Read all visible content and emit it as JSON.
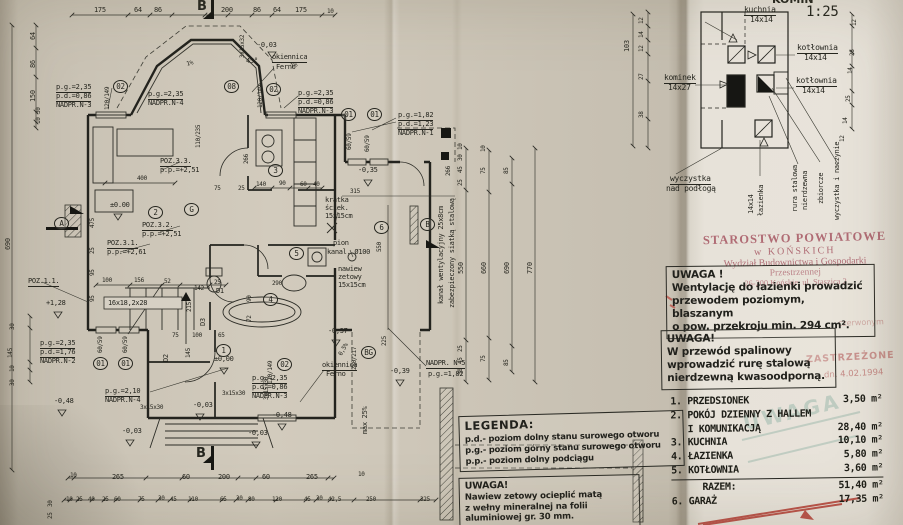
{
  "stamp": {
    "l1": "STAROSTWO POWIATOWE",
    "l2": "w KOŃSKICH",
    "l3": "Wydział Budownictwa i Gospodarki",
    "l4": "Przestrzennej",
    "l5": "26-200 Końskie, ul. Staszica 2"
  },
  "ghost": {
    "red1": "czerwonym",
    "red2": "ZASTRZEŻONE",
    "red3": "dn. 4.02.1994",
    "teal": "UWAGA"
  },
  "note_vent": {
    "title": "UWAGA !",
    "lines": [
      "Wentylację do łazienki prowadzić",
      "przewodem poziomym, blaszanym",
      "o pow. przekroju min. 294 cm²."
    ]
  },
  "note_spal": {
    "title": "UWAGA!",
    "lines": [
      "W przewód spalinowy",
      "wprowadzić rurę stalową",
      "nierdzewną kwasoodporną."
    ]
  },
  "note_nawiew": {
    "title": "UWAGA!",
    "lines": [
      "Nawiew zetowy ocieplić matą",
      "z wełny mineralnej na folii",
      "aluminiowej gr. 30 mm."
    ]
  },
  "legend": {
    "title": "LEGENDA:",
    "items": [
      "p.d.- poziom dolny stanu surowego otworu",
      "p.g.- poziom górny stanu surowego otworu",
      "p.p.- poziom dolny podciągu"
    ]
  },
  "schedule": {
    "rows": [
      {
        "l": "1. PRZEDSIONEK",
        "r": "3,50 m²"
      },
      {
        "l": "2. POKÓJ DZIENNY Z HALLEM",
        "r": ""
      },
      {
        "l": "   I KOMUNIKACJĄ",
        "r": "28,40 m²"
      },
      {
        "l": "3. KUCHNIA",
        "r": "10,10 m²"
      },
      {
        "l": "4. ŁAZIENKA",
        "r": "5,80 m²"
      },
      {
        "l": "5. KOTŁOWNIA",
        "r": "3,60 m²"
      }
    ],
    "total": {
      "l": "RAZEM:",
      "r": "51,40 m²"
    },
    "extra": {
      "l": "6. GARAŻ",
      "r": "17,35 m²"
    }
  },
  "labels": [
    {
      "t": "KOMIN",
      "x": 772,
      "y": -6,
      "s": 11,
      "k": "b"
    },
    {
      "t": "1:25",
      "x": 806,
      "y": 5,
      "s": 14
    },
    {
      "t": "kuchnia",
      "x": 744,
      "y": 6,
      "s": 8,
      "k": "u"
    },
    {
      "t": "14x14",
      "x": 750,
      "y": 16,
      "s": 8
    },
    {
      "t": "kotłownia",
      "x": 797,
      "y": 44,
      "s": 8,
      "k": "u"
    },
    {
      "t": "14x14",
      "x": 804,
      "y": 54,
      "s": 8
    },
    {
      "t": "kominek",
      "x": 664,
      "y": 74,
      "s": 8,
      "k": "u"
    },
    {
      "t": "14x27",
      "x": 668,
      "y": 84,
      "s": 8
    },
    {
      "t": "kotłownia",
      "x": 796,
      "y": 77,
      "s": 8,
      "k": "u"
    },
    {
      "t": "14x14",
      "x": 802,
      "y": 87,
      "s": 8
    },
    {
      "t": "wyczystka",
      "x": 670,
      "y": 175,
      "s": 8,
      "k": "u"
    },
    {
      "t": "nad podłogą",
      "x": 666,
      "y": 185,
      "s": 8
    },
    {
      "t": "14x14",
      "x": 748,
      "y": 214,
      "r": -90
    },
    {
      "t": "łazienka",
      "x": 758,
      "y": 216,
      "r": -90
    },
    {
      "t": "rura stalowa",
      "x": 792,
      "y": 212,
      "r": -90
    },
    {
      "t": "nierdzewna",
      "x": 802,
      "y": 210,
      "r": -90
    },
    {
      "t": "zbiorcze",
      "x": 818,
      "y": 204,
      "r": -90
    },
    {
      "t": "wyczystka i naczynie",
      "x": 834,
      "y": 220,
      "r": -90
    },
    {
      "t": "103",
      "x": 624,
      "y": 52,
      "r": -90
    },
    {
      "t": "12",
      "x": 639,
      "y": 24,
      "r": -90,
      "s": 6
    },
    {
      "t": "14",
      "x": 639,
      "y": 38,
      "r": -90,
      "s": 6
    },
    {
      "t": "12",
      "x": 639,
      "y": 52,
      "r": -90,
      "s": 6
    },
    {
      "t": "27",
      "x": 639,
      "y": 80,
      "r": -90,
      "s": 6
    },
    {
      "t": "38",
      "x": 639,
      "y": 118,
      "r": -90,
      "s": 6
    },
    {
      "t": "12",
      "x": 852,
      "y": 26,
      "r": -90,
      "s": 6
    },
    {
      "t": "26",
      "x": 850,
      "y": 56,
      "r": -90,
      "s": 6
    },
    {
      "t": "14",
      "x": 848,
      "y": 74,
      "r": -90,
      "s": 6
    },
    {
      "t": "25",
      "x": 846,
      "y": 102,
      "r": -90,
      "s": 6
    },
    {
      "t": "14",
      "x": 843,
      "y": 124,
      "r": -90,
      "s": 6
    },
    {
      "t": "12",
      "x": 840,
      "y": 142,
      "r": -90,
      "s": 6
    },
    {
      "t": "175",
      "x": 94,
      "y": 7
    },
    {
      "t": "64",
      "x": 134,
      "y": 7
    },
    {
      "t": "86",
      "x": 154,
      "y": 7
    },
    {
      "t": "B",
      "x": 197,
      "y": 0,
      "s": 13,
      "k": "b"
    },
    {
      "t": "200",
      "x": 221,
      "y": 7
    },
    {
      "t": "86",
      "x": 253,
      "y": 7
    },
    {
      "t": "64",
      "x": 273,
      "y": 7
    },
    {
      "t": "175",
      "x": 295,
      "y": 7
    },
    {
      "t": "10",
      "x": 327,
      "y": 9,
      "s": 6
    },
    {
      "t": "64",
      "x": 30,
      "y": 40,
      "r": -90
    },
    {
      "t": "86",
      "x": 30,
      "y": 68,
      "r": -90
    },
    {
      "t": "150",
      "x": 30,
      "y": 102,
      "r": -90
    },
    {
      "t": "30",
      "x": 36,
      "y": 114,
      "r": -90,
      "s": 6
    },
    {
      "t": "10",
      "x": 36,
      "y": 124,
      "r": -90,
      "s": 6
    },
    {
      "t": "690",
      "x": 5,
      "y": 250,
      "r": -90
    },
    {
      "t": "p.g.=2,35",
      "x": 56,
      "y": 84,
      "k": "u"
    },
    {
      "t": "p.d.=0,86",
      "x": 56,
      "y": 93,
      "k": "u"
    },
    {
      "t": "NADPR.N-3",
      "x": 56,
      "y": 102
    },
    {
      "t": "120/149",
      "x": 105,
      "y": 110,
      "r": -90,
      "s": 6
    },
    {
      "t": "02",
      "x": 113,
      "y": 80,
      "k": "c"
    },
    {
      "t": "p.g.=2,35",
      "x": 148,
      "y": 91,
      "k": "u"
    },
    {
      "t": "NADPR.N-4",
      "x": 148,
      "y": 100
    },
    {
      "t": "08",
      "x": 224,
      "y": 80,
      "k": "c"
    },
    {
      "t": "okiennica",
      "x": 272,
      "y": 54,
      "k": "u"
    },
    {
      "t": "Ferno",
      "x": 276,
      "y": 64
    },
    {
      "t": "3x15x32",
      "x": 240,
      "y": 58,
      "r": -90,
      "s": 6
    },
    {
      "t": "-0,03",
      "x": 257,
      "y": 42
    },
    {
      "t": "45°",
      "x": 246,
      "y": 58
    },
    {
      "t": "1%",
      "x": 186,
      "y": 62,
      "r": -15,
      "s": 6
    },
    {
      "t": "1%",
      "x": 290,
      "y": 64,
      "r": -15,
      "s": 6
    },
    {
      "t": "120/149",
      "x": 258,
      "y": 108,
      "r": -90,
      "s": 6
    },
    {
      "t": "02",
      "x": 266,
      "y": 83,
      "k": "c"
    },
    {
      "t": "p.g.=2,35",
      "x": 298,
      "y": 90,
      "k": "u"
    },
    {
      "t": "p.d.=0,86",
      "x": 298,
      "y": 99,
      "k": "u"
    },
    {
      "t": "NADPR.N-3",
      "x": 298,
      "y": 108
    },
    {
      "t": "01",
      "x": 341,
      "y": 108,
      "k": "c"
    },
    {
      "t": "01",
      "x": 367,
      "y": 108,
      "k": "c"
    },
    {
      "t": "60/59",
      "x": 347,
      "y": 150,
      "r": -90,
      "s": 6
    },
    {
      "t": "60/59",
      "x": 365,
      "y": 152,
      "r": -90,
      "s": 6
    },
    {
      "t": "p.g.=1,82",
      "x": 398,
      "y": 112,
      "k": "u"
    },
    {
      "t": "p.d.=1,23",
      "x": 398,
      "y": 121,
      "k": "u"
    },
    {
      "t": "NADPR.N-1",
      "x": 398,
      "y": 130
    },
    {
      "t": "110/235",
      "x": 196,
      "y": 148,
      "r": -90,
      "s": 6
    },
    {
      "t": "266",
      "x": 244,
      "y": 164,
      "r": -90,
      "s": 6
    },
    {
      "t": "266",
      "x": 446,
      "y": 176,
      "r": -90,
      "s": 6
    },
    {
      "t": "POZ.3.3.",
      "x": 160,
      "y": 158,
      "k": "u"
    },
    {
      "t": "p.p.=+2,51",
      "x": 160,
      "y": 167
    },
    {
      "t": "400",
      "x": 137,
      "y": 176,
      "s": 6
    },
    {
      "t": "75",
      "x": 214,
      "y": 186,
      "s": 6
    },
    {
      "t": "25",
      "x": 238,
      "y": 186,
      "s": 6
    },
    {
      "t": "±0.00",
      "x": 110,
      "y": 202
    },
    {
      "t": "2",
      "x": 148,
      "y": 206,
      "k": "c"
    },
    {
      "t": "G",
      "x": 184,
      "y": 203,
      "k": "c"
    },
    {
      "t": "POZ.3.2.",
      "x": 142,
      "y": 222,
      "k": "u"
    },
    {
      "t": "p.p.=+2,51",
      "x": 142,
      "y": 231
    },
    {
      "t": "POZ.3.1.",
      "x": 107,
      "y": 240,
      "k": "u"
    },
    {
      "t": "p.p.=+2,61",
      "x": 107,
      "y": 249
    },
    {
      "t": "POZ.1.1.",
      "x": 28,
      "y": 278,
      "k": "u"
    },
    {
      "t": "+1,28",
      "x": 46,
      "y": 300
    },
    {
      "t": "475",
      "x": 90,
      "y": 228,
      "r": -90,
      "s": 6
    },
    {
      "t": "25",
      "x": 90,
      "y": 254,
      "r": -90,
      "s": 6
    },
    {
      "t": "95",
      "x": 90,
      "y": 276,
      "r": -90,
      "s": 6
    },
    {
      "t": "95",
      "x": 90,
      "y": 302,
      "r": -90,
      "s": 6
    },
    {
      "t": "A",
      "x": 54,
      "y": 217,
      "k": "c"
    },
    {
      "t": "3",
      "x": 268,
      "y": 164,
      "k": "c"
    },
    {
      "t": "140",
      "x": 256,
      "y": 182,
      "s": 6
    },
    {
      "t": "90",
      "x": 279,
      "y": 181,
      "s": 6
    },
    {
      "t": "60",
      "x": 300,
      "y": 182,
      "s": 6
    },
    {
      "t": "40",
      "x": 313,
      "y": 182,
      "s": 6
    },
    {
      "t": "-0,35",
      "x": 358,
      "y": 167
    },
    {
      "t": "315",
      "x": 350,
      "y": 189,
      "s": 6
    },
    {
      "t": "550",
      "x": 377,
      "y": 252,
      "r": -90,
      "s": 6
    },
    {
      "t": "kratka",
      "x": 325,
      "y": 197
    },
    {
      "t": "ściek.",
      "x": 325,
      "y": 205
    },
    {
      "t": "15x15cm",
      "x": 325,
      "y": 213
    },
    {
      "t": "6",
      "x": 374,
      "y": 221,
      "k": "c"
    },
    {
      "t": "B",
      "x": 420,
      "y": 218,
      "k": "c"
    },
    {
      "t": "pion",
      "x": 333,
      "y": 240
    },
    {
      "t": "kanal. Ø100",
      "x": 327,
      "y": 249
    },
    {
      "t": "nawiew",
      "x": 338,
      "y": 266
    },
    {
      "t": "zetowy",
      "x": 338,
      "y": 274
    },
    {
      "t": "15x15cm",
      "x": 338,
      "y": 282
    },
    {
      "t": "kanał wentylacyjny 25x8cm",
      "x": 438,
      "y": 304,
      "r": -90
    },
    {
      "t": "zabezpieczony siatką stalową",
      "x": 449,
      "y": 308,
      "r": -90
    },
    {
      "t": "10",
      "x": 458,
      "y": 150,
      "r": -90,
      "s": 6
    },
    {
      "t": "30",
      "x": 458,
      "y": 161,
      "r": -90,
      "s": 6
    },
    {
      "t": "45",
      "x": 458,
      "y": 173,
      "r": -90,
      "s": 6
    },
    {
      "t": "25",
      "x": 458,
      "y": 186,
      "r": -90,
      "s": 6
    },
    {
      "t": "10",
      "x": 481,
      "y": 152,
      "r": -90,
      "s": 6
    },
    {
      "t": "75",
      "x": 481,
      "y": 174,
      "r": -90,
      "s": 6
    },
    {
      "t": "85",
      "x": 504,
      "y": 174,
      "r": -90,
      "s": 6
    },
    {
      "t": "550",
      "x": 458,
      "y": 274,
      "r": -90
    },
    {
      "t": "660",
      "x": 481,
      "y": 274,
      "r": -90
    },
    {
      "t": "690",
      "x": 504,
      "y": 274,
      "r": -90
    },
    {
      "t": "770",
      "x": 527,
      "y": 274,
      "r": -90
    },
    {
      "t": "25",
      "x": 458,
      "y": 352,
      "r": -90,
      "s": 6
    },
    {
      "t": "45",
      "x": 458,
      "y": 364,
      "r": -90,
      "s": 6
    },
    {
      "t": "30",
      "x": 458,
      "y": 375,
      "r": -90,
      "s": 6
    },
    {
      "t": "75",
      "x": 481,
      "y": 362,
      "r": -90,
      "s": 6
    },
    {
      "t": "85",
      "x": 504,
      "y": 366,
      "r": -90,
      "s": 6
    },
    {
      "t": "225",
      "x": 382,
      "y": 346,
      "r": -90,
      "s": 6
    },
    {
      "t": "-0,37",
      "x": 328,
      "y": 328
    },
    {
      "t": "0,5%",
      "x": 338,
      "y": 354,
      "r": -60,
      "s": 6
    },
    {
      "t": "250/217",
      "x": 352,
      "y": 370,
      "r": -90,
      "s": 6
    },
    {
      "t": "BG",
      "x": 361,
      "y": 346,
      "k": "c"
    },
    {
      "t": "-0,39",
      "x": 390,
      "y": 368
    },
    {
      "t": "max 25%",
      "x": 362,
      "y": 434,
      "r": -90
    },
    {
      "t": "NADPR. N-5",
      "x": 426,
      "y": 360,
      "k": "u"
    },
    {
      "t": "p.g.=1,82",
      "x": 428,
      "y": 371
    },
    {
      "t": "okiennica",
      "x": 322,
      "y": 362,
      "k": "u"
    },
    {
      "t": "Ferno",
      "x": 326,
      "y": 371
    },
    {
      "t": "02",
      "x": 277,
      "y": 358,
      "k": "c"
    },
    {
      "t": "120/149",
      "x": 268,
      "y": 384,
      "r": -90,
      "s": 6
    },
    {
      "t": "p.g.=2,35",
      "x": 252,
      "y": 375,
      "k": "u"
    },
    {
      "t": "p.d.=0,86",
      "x": 252,
      "y": 384,
      "k": "u"
    },
    {
      "t": "NADPR.N-3",
      "x": 252,
      "y": 393
    },
    {
      "t": "-0,48",
      "x": 272,
      "y": 412
    },
    {
      "t": "142",
      "x": 194,
      "y": 286,
      "s": 6
    },
    {
      "t": "25",
      "x": 214,
      "y": 280,
      "s": 6
    },
    {
      "t": "D1",
      "x": 216,
      "y": 288
    },
    {
      "t": "215",
      "x": 187,
      "y": 312,
      "r": -90,
      "s": 6
    },
    {
      "t": "100",
      "x": 102,
      "y": 278,
      "s": 6
    },
    {
      "t": "156",
      "x": 134,
      "y": 278,
      "s": 6
    },
    {
      "t": "52",
      "x": 164,
      "y": 279,
      "s": 6
    },
    {
      "t": "16x18,2x28",
      "x": 108,
      "y": 300
    },
    {
      "t": "4",
      "x": 263,
      "y": 293,
      "k": "c"
    },
    {
      "t": "290",
      "x": 272,
      "y": 281,
      "s": 6
    },
    {
      "t": "5",
      "x": 289,
      "y": 247,
      "k": "c"
    },
    {
      "t": "D3",
      "x": 200,
      "y": 326,
      "r": -90
    },
    {
      "t": "D2",
      "x": 163,
      "y": 362,
      "r": -90
    },
    {
      "t": "90",
      "x": 247,
      "y": 302,
      "r": -90,
      "s": 6
    },
    {
      "t": "72",
      "x": 247,
      "y": 322,
      "r": -90,
      "s": 6
    },
    {
      "t": "1",
      "x": 216,
      "y": 344,
      "k": "c"
    },
    {
      "t": "±0,00",
      "x": 214,
      "y": 356
    },
    {
      "t": "75",
      "x": 172,
      "y": 333,
      "s": 6
    },
    {
      "t": "100",
      "x": 192,
      "y": 333,
      "s": 6
    },
    {
      "t": "65",
      "x": 218,
      "y": 333,
      "s": 6
    },
    {
      "t": "145",
      "x": 186,
      "y": 358,
      "r": -90,
      "s": 6
    },
    {
      "t": "p.g.=2,35",
      "x": 40,
      "y": 340,
      "k": "u"
    },
    {
      "t": "p.d.=1,76",
      "x": 40,
      "y": 349,
      "k": "u"
    },
    {
      "t": "NADPR.N-2",
      "x": 40,
      "y": 358
    },
    {
      "t": "60/59",
      "x": 98,
      "y": 353,
      "r": -90,
      "s": 6
    },
    {
      "t": "60/59",
      "x": 123,
      "y": 353,
      "r": -90,
      "s": 6
    },
    {
      "t": "01",
      "x": 93,
      "y": 357,
      "k": "c"
    },
    {
      "t": "01",
      "x": 118,
      "y": 357,
      "k": "c"
    },
    {
      "t": "p.g.=2,10",
      "x": 105,
      "y": 388,
      "k": "u"
    },
    {
      "t": "NADPR.N-4",
      "x": 105,
      "y": 397
    },
    {
      "t": "-0,48",
      "x": 54,
      "y": 398
    },
    {
      "t": "3x15x30",
      "x": 140,
      "y": 405,
      "s": 6
    },
    {
      "t": "3x15x30",
      "x": 222,
      "y": 391,
      "s": 6
    },
    {
      "t": "3x15x30",
      "x": 264,
      "y": 400,
      "r": -90,
      "s": 6
    },
    {
      "t": "-0,03",
      "x": 193,
      "y": 402
    },
    {
      "t": "-0,03",
      "x": 122,
      "y": 428
    },
    {
      "t": "-0,03",
      "x": 248,
      "y": 430
    },
    {
      "t": "30",
      "x": 10,
      "y": 330,
      "r": -90,
      "s": 6
    },
    {
      "t": "145",
      "x": 8,
      "y": 358,
      "r": -90,
      "s": 6
    },
    {
      "t": "10",
      "x": 10,
      "y": 372,
      "r": -90,
      "s": 6
    },
    {
      "t": "30",
      "x": 10,
      "y": 386,
      "r": -90,
      "s": 6
    },
    {
      "t": "B",
      "x": 196,
      "y": 447,
      "s": 13,
      "k": "b"
    },
    {
      "t": "10",
      "x": 70,
      "y": 473,
      "s": 6
    },
    {
      "t": "265",
      "x": 112,
      "y": 474
    },
    {
      "t": "60",
      "x": 182,
      "y": 474
    },
    {
      "t": "200",
      "x": 218,
      "y": 474
    },
    {
      "t": "60",
      "x": 262,
      "y": 474
    },
    {
      "t": "265",
      "x": 306,
      "y": 474
    },
    {
      "t": "10",
      "x": 358,
      "y": 472,
      "s": 6
    },
    {
      "t": "10",
      "x": 66,
      "y": 497,
      "s": 6
    },
    {
      "t": "25",
      "x": 76,
      "y": 497,
      "s": 6
    },
    {
      "t": "40",
      "x": 88,
      "y": 497,
      "s": 6
    },
    {
      "t": "25",
      "x": 102,
      "y": 497,
      "s": 6
    },
    {
      "t": "60",
      "x": 114,
      "y": 497,
      "s": 6
    },
    {
      "t": "75",
      "x": 138,
      "y": 497,
      "s": 6
    },
    {
      "t": "30",
      "x": 158,
      "y": 496,
      "s": 6
    },
    {
      "t": "45",
      "x": 170,
      "y": 497,
      "s": 6
    },
    {
      "t": "110",
      "x": 188,
      "y": 497,
      "s": 6
    },
    {
      "t": "65",
      "x": 220,
      "y": 497,
      "s": 6
    },
    {
      "t": "30",
      "x": 236,
      "y": 496,
      "s": 6
    },
    {
      "t": "80",
      "x": 248,
      "y": 497,
      "s": 6
    },
    {
      "t": "120",
      "x": 272,
      "y": 497,
      "s": 6
    },
    {
      "t": "45",
      "x": 304,
      "y": 497,
      "s": 6
    },
    {
      "t": "30",
      "x": 316,
      "y": 496,
      "s": 6
    },
    {
      "t": "42,5",
      "x": 328,
      "y": 497,
      "s": 6
    },
    {
      "t": "250",
      "x": 366,
      "y": 497,
      "s": 6
    },
    {
      "t": "325",
      "x": 420,
      "y": 497,
      "s": 6
    },
    {
      "t": "30",
      "x": 48,
      "y": 507,
      "r": -90,
      "s": 6
    },
    {
      "t": "25",
      "x": 48,
      "y": 519,
      "r": -90,
      "s": 6
    }
  ]
}
